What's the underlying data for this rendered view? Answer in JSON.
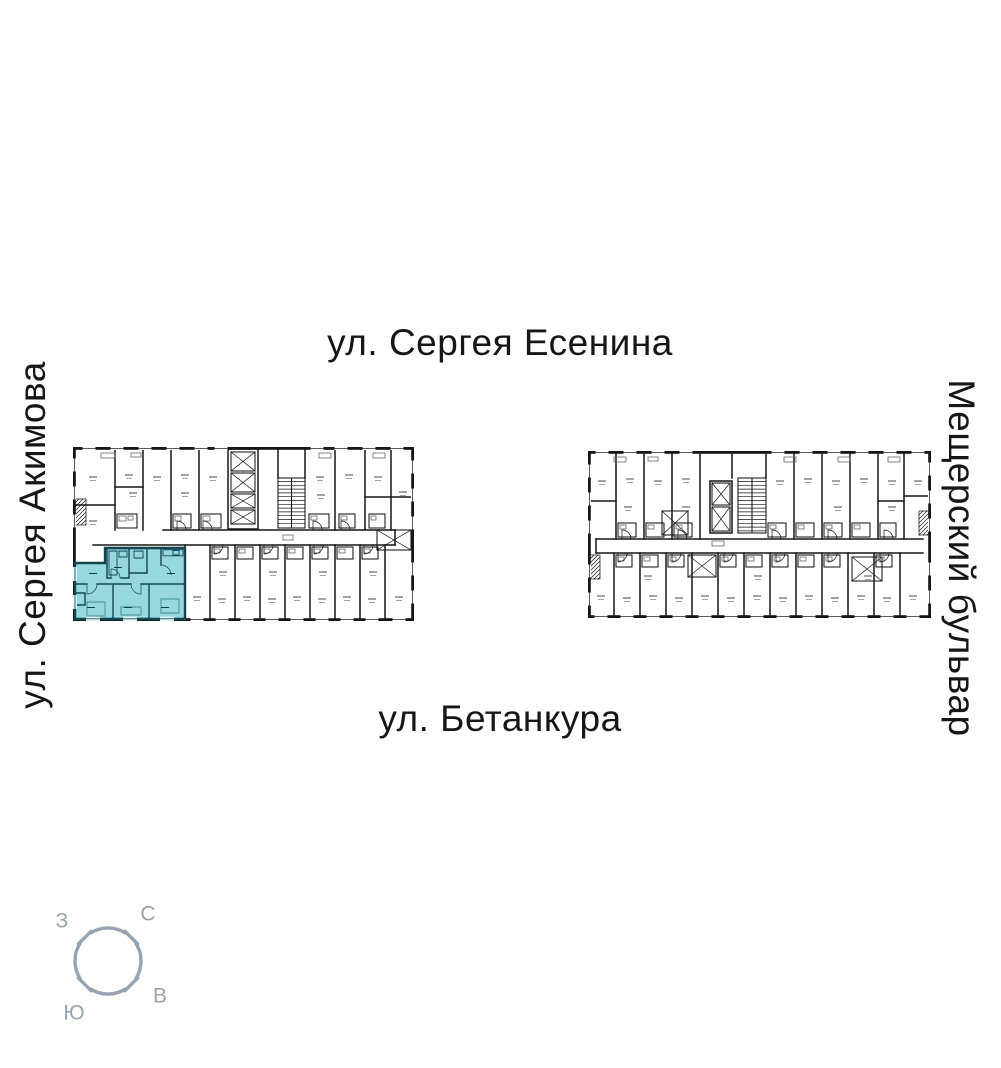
{
  "streets": {
    "top": "ул. Сергея Есенина",
    "bottom": "ул. Бетанкура",
    "left": "ул. Сергея Акимова",
    "right": "Мещерский бульвар"
  },
  "compass": {
    "west": "З",
    "north": "С",
    "east": "В",
    "south": "Ю"
  },
  "colors": {
    "plan_line": "#161616",
    "highlight_fill": "#96d8de",
    "highlight_wall": "#14454f",
    "compass": "#96a3b1"
  }
}
